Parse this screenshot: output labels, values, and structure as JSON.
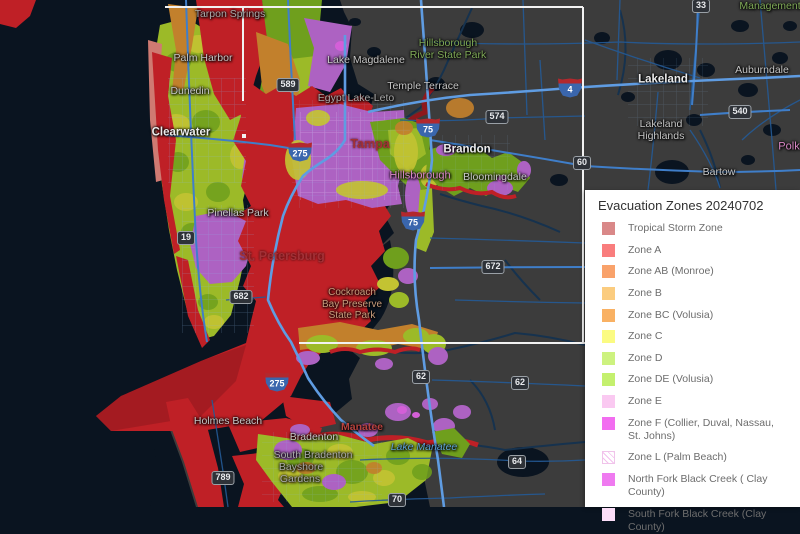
{
  "legend": {
    "title": "Evacuation Zones 20240702",
    "items": [
      {
        "label": "Tropical Storm Zone",
        "color": "#d98888"
      },
      {
        "label": "Zone A",
        "color": "#f97d7d"
      },
      {
        "label": "Zone AB (Monroe)",
        "color": "#f9a26b"
      },
      {
        "label": "Zone B",
        "color": "#fbcc7f"
      },
      {
        "label": "Zone BC (Volusia)",
        "color": "#f9b163"
      },
      {
        "label": "Zone C",
        "color": "#fbfb82"
      },
      {
        "label": "Zone D",
        "color": "#cdf27f"
      },
      {
        "label": "Zone DE (Volusia)",
        "color": "#c4f06e"
      },
      {
        "label": "Zone E",
        "color": "#fac9f1"
      },
      {
        "label": "Zone F (Collier, Duval, Nassau, St. Johns)",
        "color": "#f26df0"
      },
      {
        "label": "Zone L (Palm Beach)",
        "color": "#ffffff",
        "hatch": true
      },
      {
        "label": "North Fork Black Creek ( Clay County)",
        "color": "#ef7af0"
      },
      {
        "label": "South Fork Black Creek (Clay County)",
        "color": "#fcdef8"
      }
    ]
  },
  "map": {
    "labels": [
      {
        "name": "tarpon-springs",
        "text": "Tarpon Springs"
      },
      {
        "name": "palm-harbor",
        "text": "Palm Harbor"
      },
      {
        "name": "dunedin",
        "text": "Dunedin"
      },
      {
        "name": "clearwater",
        "text": "Clearwater"
      },
      {
        "name": "lake-magdalene",
        "text": "Lake Magdalene"
      },
      {
        "name": "hillsborough-river-state-park",
        "text": "Hillsborough\nRiver State Park"
      },
      {
        "name": "temple-terrace",
        "text": "Temple Terrace"
      },
      {
        "name": "egypt-lake-leto",
        "text": "Egypt Lake-Leto"
      },
      {
        "name": "tampa",
        "text": "Tampa"
      },
      {
        "name": "brandon",
        "text": "Brandon"
      },
      {
        "name": "bloomingdale",
        "text": "Bloomingdale"
      },
      {
        "name": "hillsborough-county",
        "text": "Hillsborough"
      },
      {
        "name": "lakeland",
        "text": "Lakeland"
      },
      {
        "name": "auburndale",
        "text": "Auburndale"
      },
      {
        "name": "lakeland-highlands",
        "text": "Lakeland\nHighlands"
      },
      {
        "name": "polk-county",
        "text": "Polk"
      },
      {
        "name": "bartow",
        "text": "Bartow"
      },
      {
        "name": "management",
        "text": "Management"
      },
      {
        "name": "pinellas-park",
        "text": "Pinellas Park"
      },
      {
        "name": "st-petersburg",
        "text": "St. Petersburg"
      },
      {
        "name": "cockroach-bay",
        "text": "Cockroach\nBay Preserve\nState Park"
      },
      {
        "name": "holmes-beach",
        "text": "Holmes Beach"
      },
      {
        "name": "bradenton",
        "text": "Bradenton"
      },
      {
        "name": "manatee-county",
        "text": "Manatee"
      },
      {
        "name": "south-bradenton",
        "text": "South Bradenton"
      },
      {
        "name": "bayshore",
        "text": "Bayshore"
      },
      {
        "name": "gardens",
        "text": "Gardens"
      },
      {
        "name": "lake-manatee",
        "text": "Lake Manatee"
      }
    ],
    "shields": [
      {
        "text": "589"
      },
      {
        "text": "574"
      },
      {
        "text": "60"
      },
      {
        "text": "33"
      },
      {
        "text": "540"
      },
      {
        "text": "62"
      },
      {
        "text": "62"
      },
      {
        "text": "64"
      },
      {
        "text": "70"
      },
      {
        "text": "672"
      },
      {
        "text": "19"
      },
      {
        "text": "682"
      },
      {
        "text": "789"
      }
    ],
    "interstates": [
      {
        "text": "275"
      },
      {
        "text": "75"
      },
      {
        "text": "75"
      },
      {
        "text": "4"
      },
      {
        "text": "275"
      }
    ],
    "colors": {
      "water": "#0a1420",
      "land": "#3c3c3c",
      "urban": "#474747",
      "red": "#bf2026",
      "darkred": "#8e181d",
      "salmon": "#cf7a72",
      "orange": "#c2802c",
      "yellow": "#c3c332",
      "ygreen": "#9cba28",
      "green": "#6f9f1d",
      "violet": "#ad62c2",
      "magenta": "#d45fd8",
      "road": "#3f7ec9",
      "roadminor": "#245a96",
      "river": "#16324e",
      "hwy": "#5f9ce2",
      "extent": "#f2f2f2"
    }
  }
}
